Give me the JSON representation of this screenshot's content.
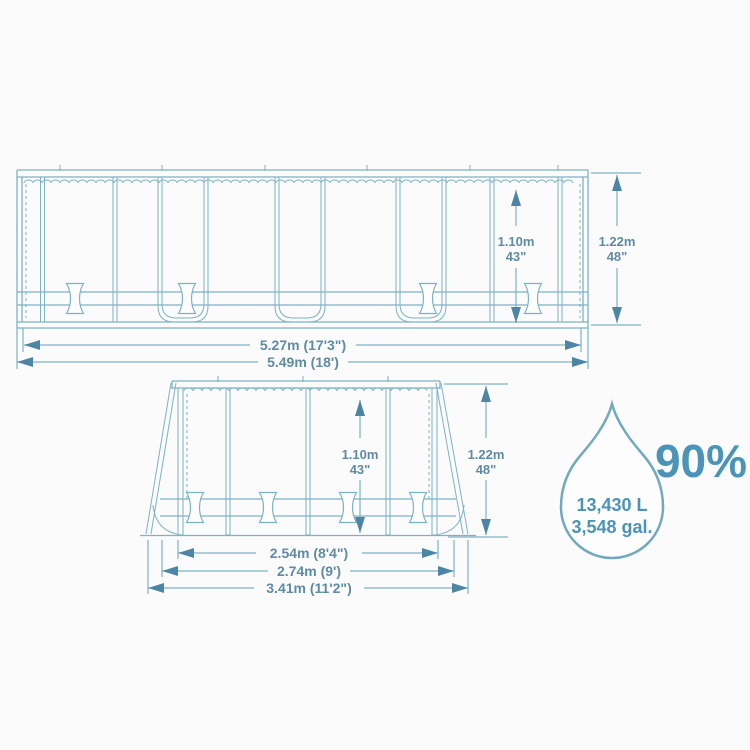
{
  "diagram": {
    "side_view": {
      "water_height_m": "1.10m",
      "water_height_in": "43\"",
      "frame_height_m": "1.22m",
      "frame_height_in": "48\"",
      "inner_length": "5.27m (17'3\")",
      "outer_length": "5.49m (18')"
    },
    "end_view": {
      "water_height_m": "1.10m",
      "water_height_in": "43\"",
      "frame_height_m": "1.22m",
      "frame_height_in": "48\"",
      "inner_width": "2.54m (8'4\")",
      "frame_width": "2.74m (9')",
      "outer_width": "3.41m (11'2\")"
    },
    "capacity": {
      "fill_percent": "90%",
      "volume_liters": "13,430 L",
      "volume_gallons": "3,548 gal."
    },
    "colors": {
      "line": "#7db2c6",
      "dim_text": "#5f8ba3",
      "arrow": "#4d85a4",
      "accent": "#4b94b8",
      "drop_outline": "#72a9bd",
      "background": "#fbfbfb"
    }
  }
}
